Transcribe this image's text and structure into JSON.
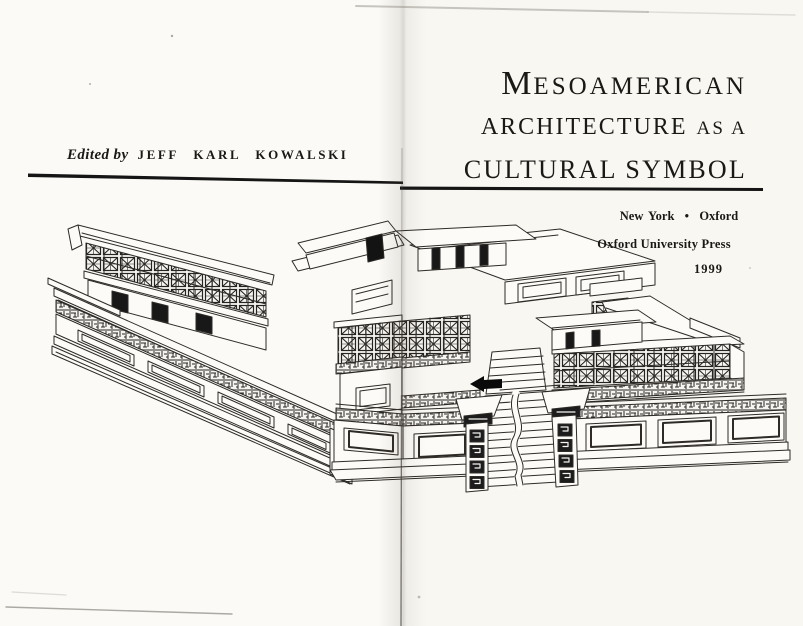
{
  "left_page": {
    "edited_by_label": "Edited by",
    "editor_name": "JEFF KARL KOWALSKI"
  },
  "right_page": {
    "title": {
      "line1_initial": "M",
      "line1_rest": "ESOAMERICAN",
      "line2_main": "ARCHITECTURE",
      "line2_small": "AS A",
      "line3": "CULTURAL SYMBOL"
    },
    "imprint": {
      "cities": "New York  •  Oxford",
      "publisher": "Oxford University Press",
      "year": "1999"
    }
  },
  "illustration": {
    "name": "maya-quadrangle-line-drawing",
    "description": "Pen-and-ink perspective drawing of a Puuc-style Maya palace quadrangle with lattice friezes, terraced platforms and a central staircase"
  },
  "colors": {
    "paper": "#fbfaf6",
    "ink": "#2e2b27"
  }
}
